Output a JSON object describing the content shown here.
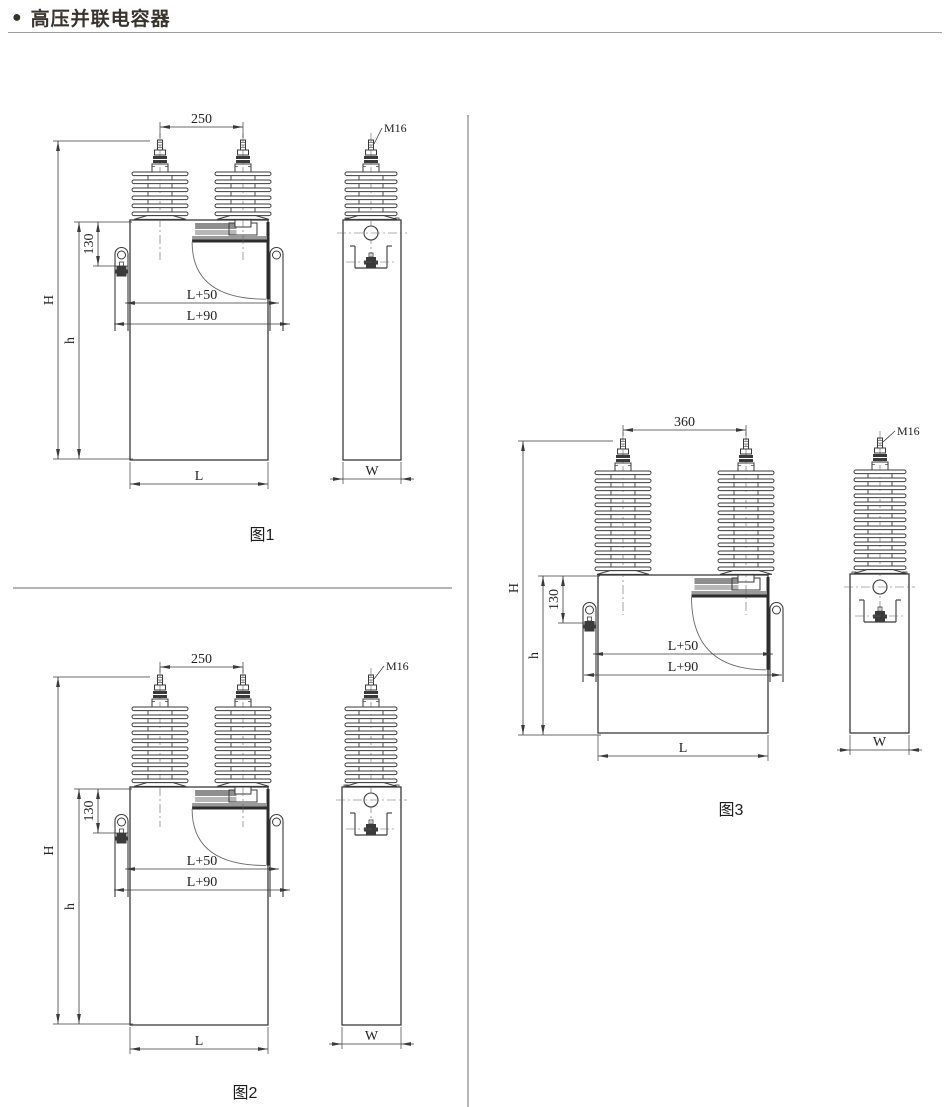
{
  "header": {
    "bullet": "●",
    "title": "高压并联电容器"
  },
  "figures": [
    {
      "caption": "图1",
      "dims": {
        "terminal_spacing": "250",
        "terminal_thread": "M16",
        "cover_to_bolt": "130",
        "l_plus_50": "L+50",
        "l_plus_90": "L+90",
        "total_height": "H",
        "tank_height": "h",
        "tank_length": "L",
        "tank_width": "W"
      }
    },
    {
      "caption": "图2",
      "dims": {
        "terminal_spacing": "250",
        "terminal_thread": "M16",
        "cover_to_bolt": "130",
        "l_plus_50": "L+50",
        "l_plus_90": "L+90",
        "total_height": "H",
        "tank_height": "h",
        "tank_length": "L",
        "tank_width": "W"
      }
    },
    {
      "caption": "图3",
      "dims": {
        "terminal_spacing": "360",
        "terminal_thread": "M16",
        "cover_to_bolt": "130",
        "l_plus_50": "L+50",
        "l_plus_90": "L+90",
        "total_height": "H",
        "tank_height": "h",
        "tank_length": "L",
        "tank_width": "W"
      }
    }
  ],
  "colors": {
    "line": "#3a3a3a",
    "title_text": "#39332d",
    "divider": "#b5b5b5",
    "nameplate_dark": "#8e8e8e",
    "nameplate_light": "#b7b7b7"
  }
}
